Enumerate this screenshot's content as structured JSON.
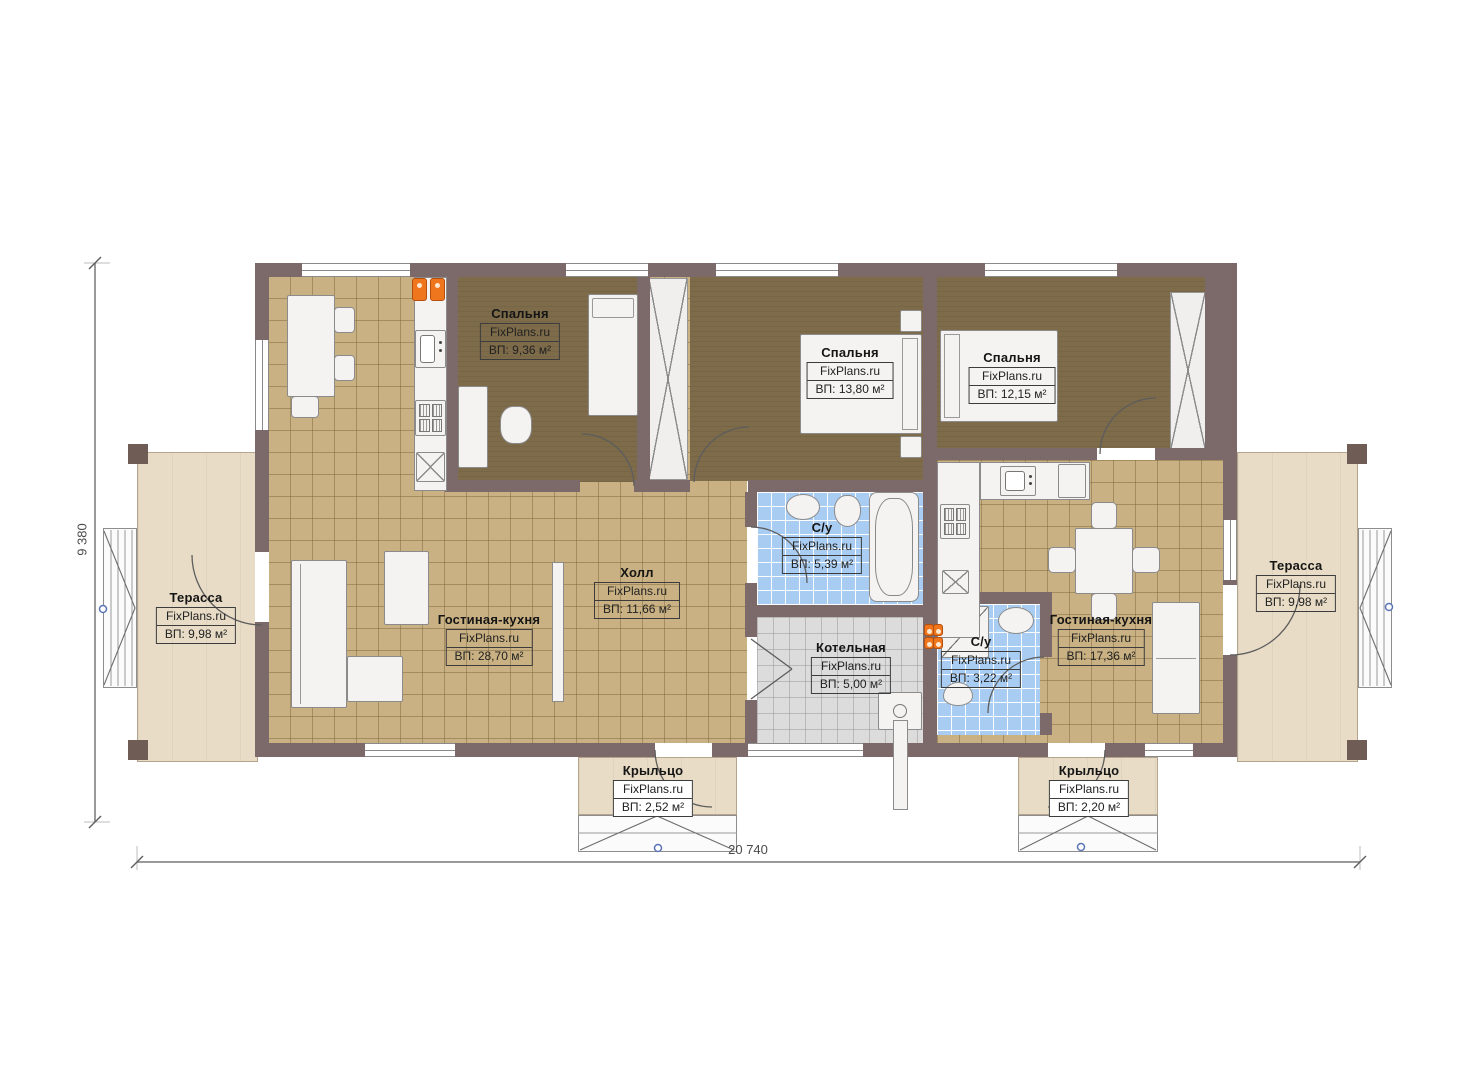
{
  "brand_watermark": "FixPlans.ru",
  "rooms": [
    {
      "id": "bedroom-1",
      "name": "Спальня",
      "brand": "FixPlans.ru",
      "area": "ВП: 9,36 м²"
    },
    {
      "id": "bedroom-2",
      "name": "Спальня",
      "brand": "FixPlans.ru",
      "area": "ВП: 13,80 м²"
    },
    {
      "id": "bedroom-3",
      "name": "Спальня",
      "brand": "FixPlans.ru",
      "area": "ВП: 12,15 м²"
    },
    {
      "id": "living-kitchen-left",
      "name": "Гостиная-кухня",
      "brand": "FixPlans.ru",
      "area": "ВП: 28,70 м²"
    },
    {
      "id": "hall",
      "name": "Холл",
      "brand": "FixPlans.ru",
      "area": "ВП: 11,66 м²"
    },
    {
      "id": "bathroom-1",
      "name": "С/у",
      "brand": "FixPlans.ru",
      "area": "ВП: 5,39 м²"
    },
    {
      "id": "boiler-room",
      "name": "Котельная",
      "brand": "FixPlans.ru",
      "area": "ВП: 5,00 м²"
    },
    {
      "id": "bathroom-2",
      "name": "С/у",
      "brand": "FixPlans.ru",
      "area": "ВП: 3,22 м²"
    },
    {
      "id": "living-kitchen-right",
      "name": "Гостиная-кухня",
      "brand": "FixPlans.ru",
      "area": "ВП: 17,36 м²"
    },
    {
      "id": "terrace-left",
      "name": "Терасса",
      "brand": "FixPlans.ru",
      "area": "ВП: 9,98 м²"
    },
    {
      "id": "terrace-right",
      "name": "Терасса",
      "brand": "FixPlans.ru",
      "area": "ВП: 9,98 м²"
    },
    {
      "id": "porch-left",
      "name": "Крыльцо",
      "brand": "FixPlans.ru",
      "area": "ВП: 2,52 м²"
    },
    {
      "id": "porch-right",
      "name": "Крыльцо",
      "brand": "FixPlans.ru",
      "area": "ВП: 2,20 м²"
    }
  ],
  "dimensions": {
    "overall_width": "20 740",
    "overall_height": "9 380"
  },
  "colors": {
    "wall": "#7c6a6a",
    "floor_tile_tan": "#c9b183",
    "floor_bedroom": "#7d6b4a",
    "floor_bathroom": "#a9cdf2",
    "floor_boiler": "#dcdcdc",
    "terrace": "#e8dcc6",
    "accent_orange": "#f0761e",
    "marker_blue": "#5a74b8"
  }
}
